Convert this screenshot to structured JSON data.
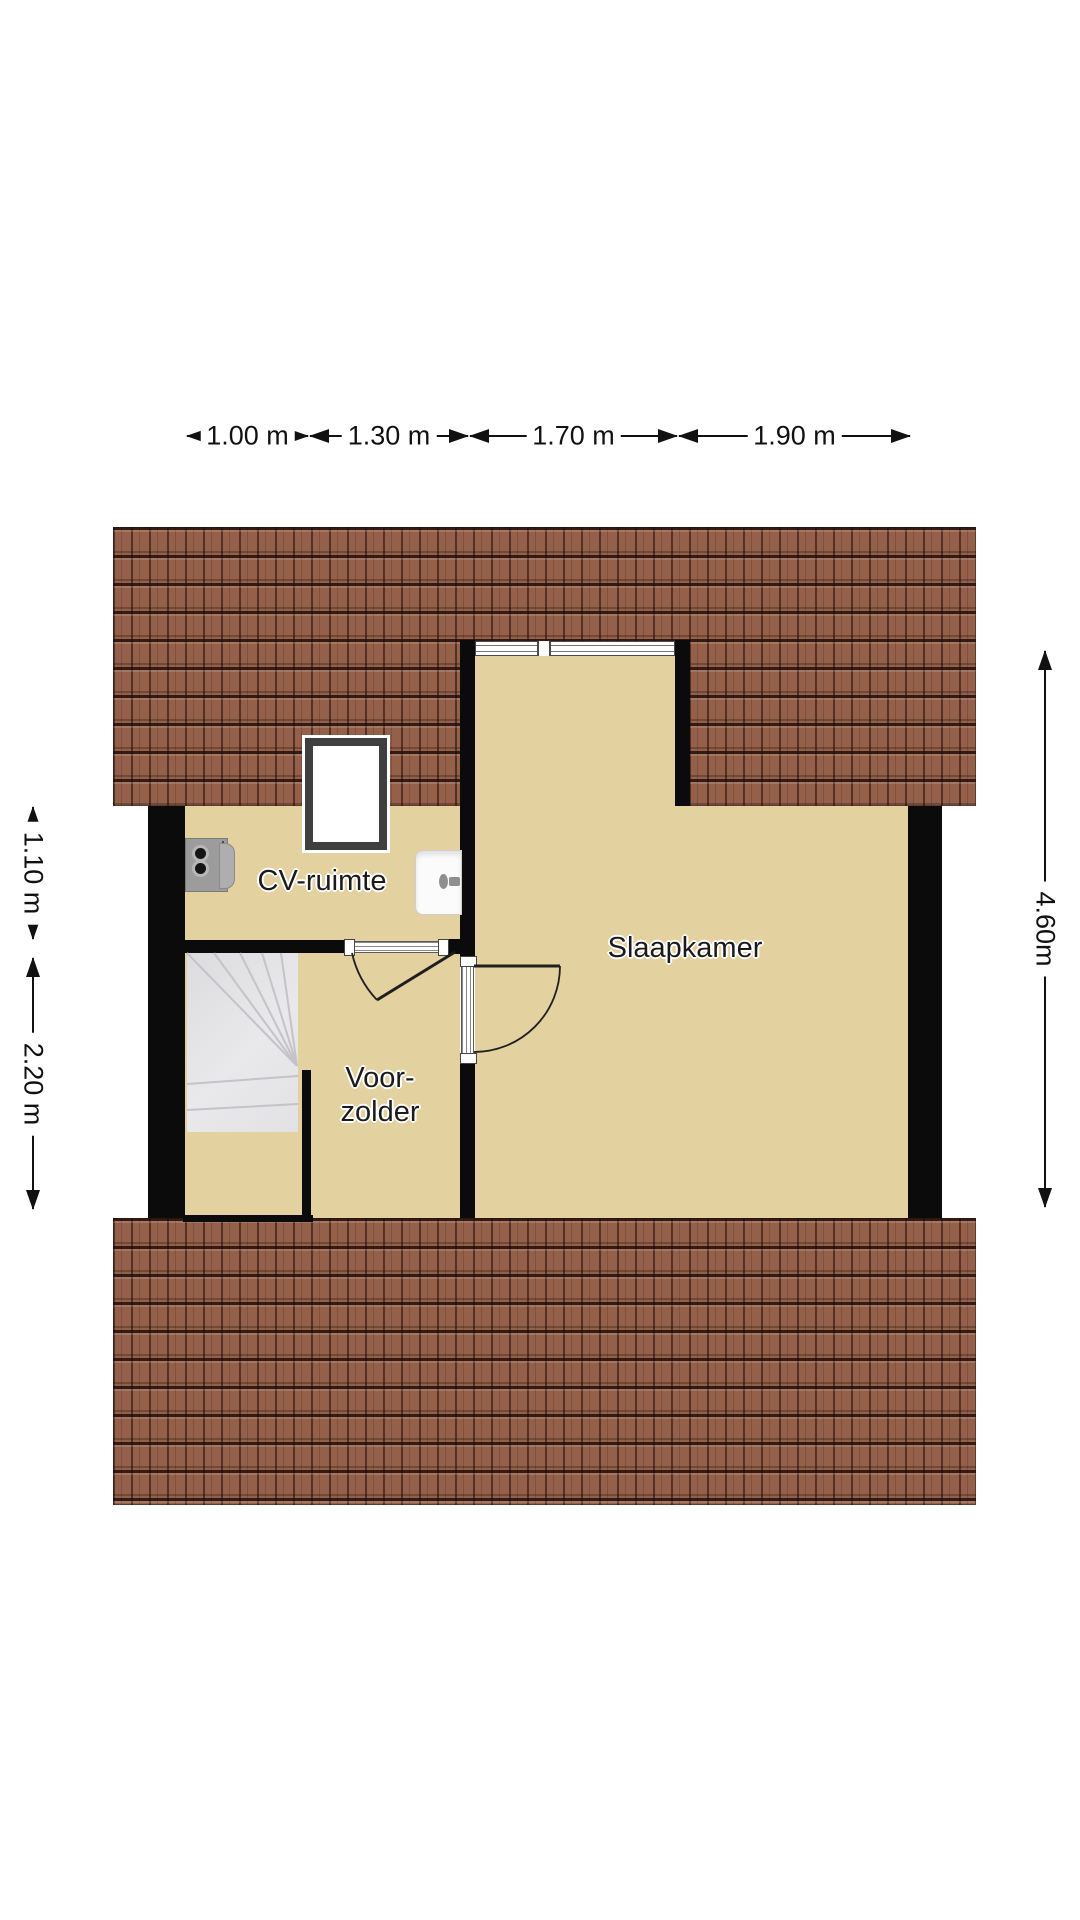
{
  "plan_title": "attic floor plan",
  "rooms": {
    "cv": "CV-ruimte",
    "slaapkamer": "Slaapkamer",
    "voorzolder_line1": "Voor-",
    "voorzolder_line2": "zolder"
  },
  "dimensions": {
    "top": [
      {
        "label": "1.00 m"
      },
      {
        "label": "1.30 m"
      },
      {
        "label": "1.70 m"
      },
      {
        "label": "1.90 m"
      }
    ],
    "left": [
      {
        "label": "1.10 m"
      },
      {
        "label": "2.20 m"
      }
    ],
    "right": [
      {
        "label": "4.60m"
      }
    ]
  },
  "fixtures": {
    "roof_window": "roof-window",
    "boiler": "cv-boiler",
    "sink": "hand-basin",
    "stairs": "winder-staircase",
    "window_band": "bedroom-window",
    "doors": [
      "cv-ruimte-door",
      "slaapkamer-door"
    ]
  },
  "colors": {
    "floor": "#e4d1a0",
    "wall": "#0b0b0b",
    "roof": "#95604a",
    "stairs": "#e5e5e8",
    "text": "#111111"
  }
}
